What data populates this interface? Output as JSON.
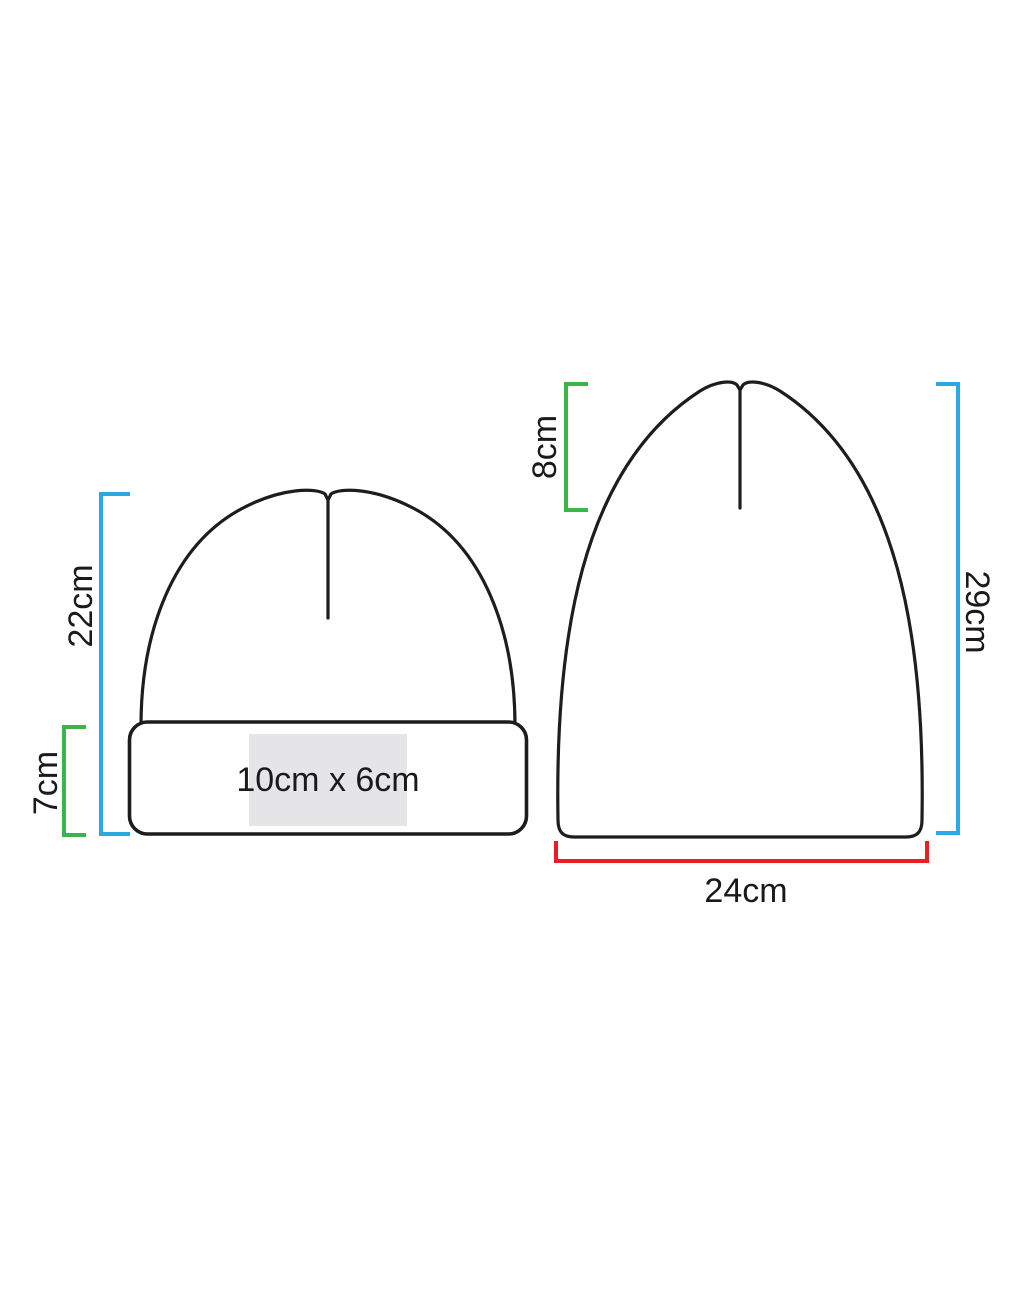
{
  "colors": {
    "outline": "#1d1d1b",
    "text": "#1a1a1a",
    "bracket_height": "#29abe2",
    "bracket_fold": "#3ab54a",
    "bracket_width": "#ec1c24",
    "print_area_fill": "#e5e5e7",
    "background": "#ffffff"
  },
  "folded_beanie": {
    "total_height_label": "22cm",
    "cuff_height_label": "7cm",
    "print_area_label": "10cm x 6cm"
  },
  "unfolded_beanie": {
    "fold_depth_label": "8cm",
    "total_height_label": "29cm",
    "width_label": "24cm"
  }
}
